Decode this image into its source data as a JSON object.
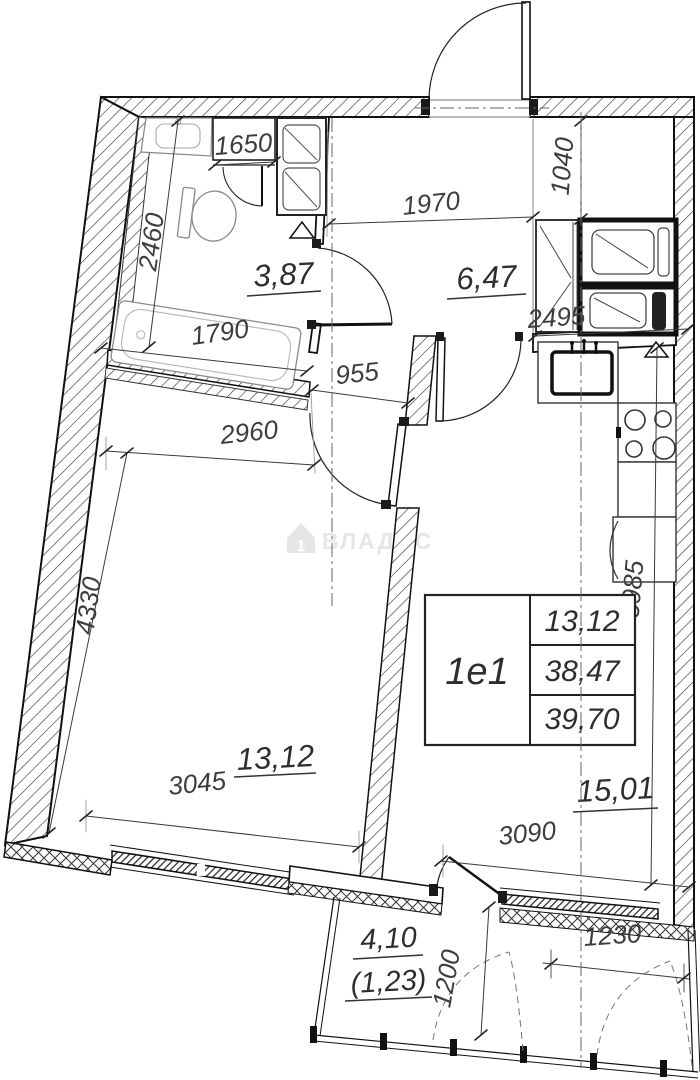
{
  "watermark": {
    "label": "ВЛАДИС"
  },
  "unit_card": {
    "id": "1e1",
    "rows": [
      "13,12",
      "38,47",
      "39,70"
    ]
  },
  "rooms": {
    "bathroom": {
      "area": "3,87"
    },
    "hallway": {
      "area": "6,47"
    },
    "bedroom": {
      "area": "13,12"
    },
    "kitchen_living": {
      "area": "15,01"
    },
    "balcony": {
      "area": "4,10",
      "reduced_area": "(1,23)"
    }
  },
  "dimensions_mm": {
    "bathroom_unit_width": "1650",
    "bathroom_depth": "2460",
    "bathtub_length": "1790",
    "hallway_width": "1970",
    "entry_zone_depth": "1040",
    "hallway_length": "2495",
    "corridor_opening_width": "955",
    "bedroom_width_top": "2960",
    "bedroom_length": "4330",
    "bedroom_width_bottom": "3045",
    "kitchen_length": "5985",
    "kitchen_width": "3090",
    "balcony_depth": "1200",
    "balcony_section_width": "1230"
  },
  "colors": {
    "wall_line": "#111111",
    "dim_text": "#3d3d3d",
    "watermark": "#e6e6e6",
    "background": "#ffffff"
  }
}
